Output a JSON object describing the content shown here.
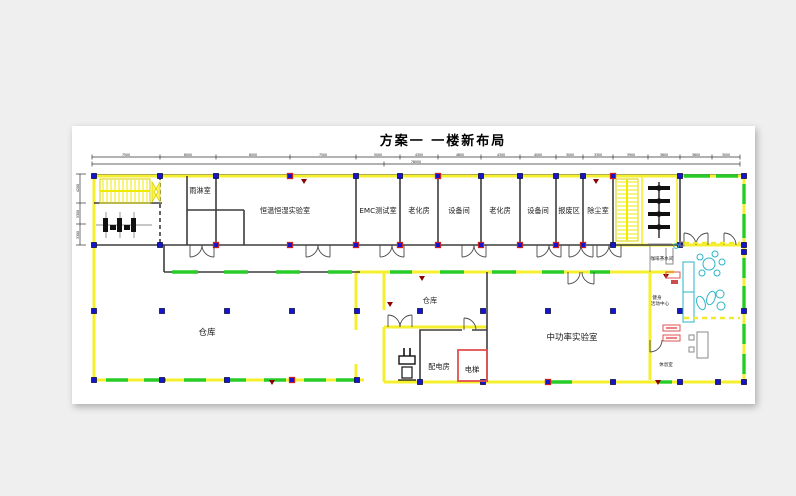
{
  "title": "方案一 一楼新布局",
  "watermark": "Autodesk",
  "rooms": {
    "rain_shower": "雨淋室",
    "climate_lab": "恒温恒湿实验室",
    "emc_lab": "EMC测试室",
    "aging_1": "老化房",
    "equipment_1": "设备间",
    "aging_2": "老化房",
    "equipment_2": "设备间",
    "scrap_area": "报废区",
    "dust_room": "除尘室",
    "warehouse_main": "仓库",
    "warehouse_small": "仓库",
    "power_distribution": "配电房",
    "elevator": "电梯",
    "mid_power_lab": "中功率实验室",
    "coffee_pantry": "咖啡茶水间",
    "fitness_center_line1": "健身",
    "fitness_center_line2": "活动中心",
    "lounge": "休息室"
  },
  "dims": {
    "top": [
      "7500",
      "6000",
      "8000",
      "7500",
      "5000",
      "4300",
      "4800",
      "4300",
      "4000",
      "3000",
      "3300",
      "3900",
      "3600",
      "3600",
      "3000"
    ],
    "top_overall": "78000",
    "left": [
      "4200",
      "3300",
      "3300"
    ]
  }
}
